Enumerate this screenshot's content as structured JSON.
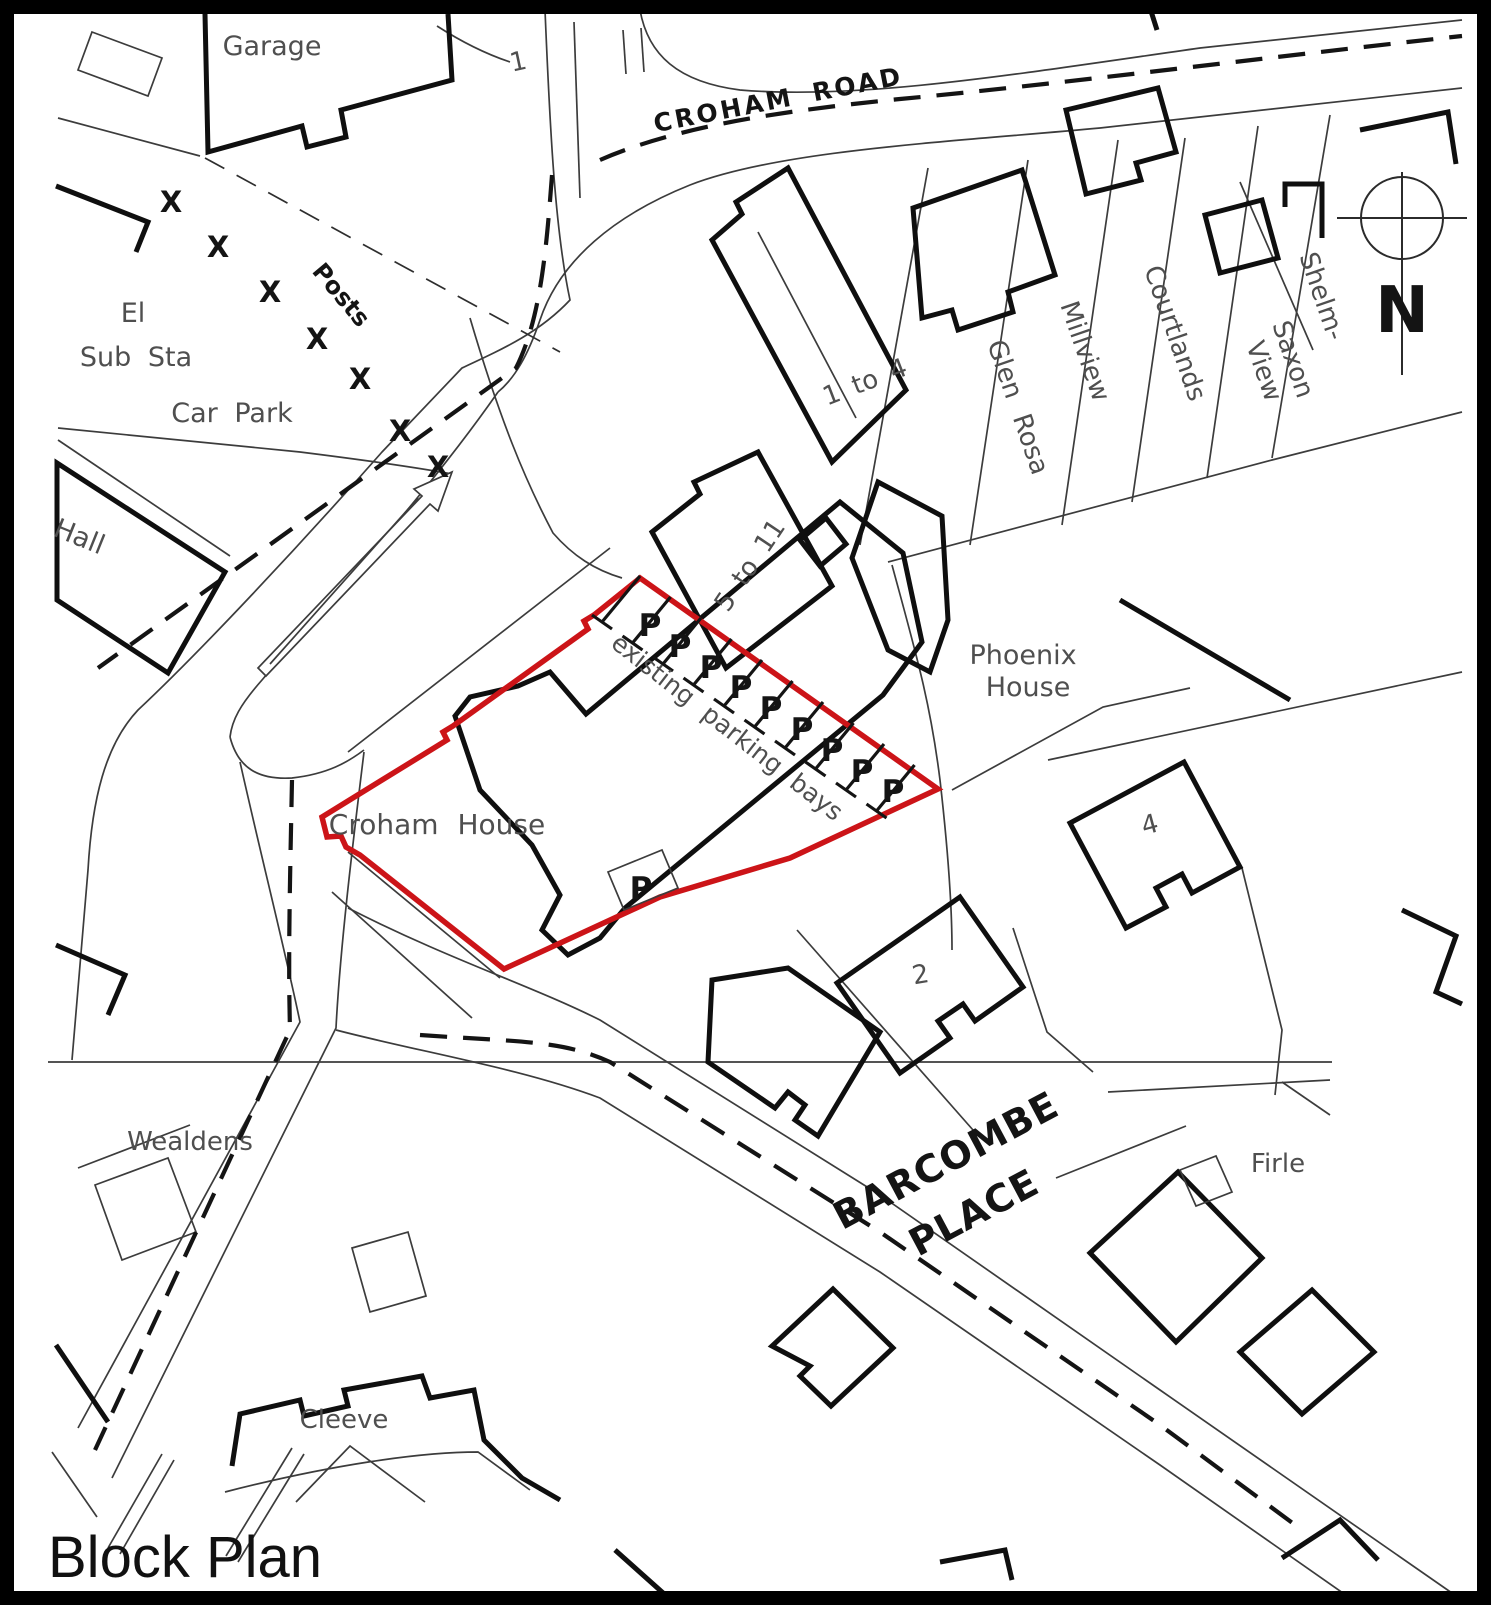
{
  "title": "Block Plan",
  "colors": {
    "site_boundary_red": "#cc1418",
    "building_line": "#0f0f0f",
    "thin_line": "#3c3c3c",
    "label_grey": "#4f4f4f",
    "background": "#ffffff"
  },
  "map": {
    "site": {
      "name": "Croham House",
      "boundary_color": "#cc1418",
      "parking_note": "existing parking bays",
      "parking_bays_in_row": 9,
      "detached_parking_bays": 1
    },
    "roads": [
      "CROHAM ROAD",
      "BARCOMBE PLACE"
    ],
    "places": [
      "Garage",
      "El Sub Sta",
      "Car Park",
      "Posts",
      "Hall",
      "1",
      "1 to 4",
      "5 to 11",
      "Glen Rosa",
      "Millview",
      "Courtlands",
      "Saxon View",
      "Shelm-",
      "Phoenix House",
      "2",
      "4",
      "Wealdens",
      "Firle",
      "Cleeve"
    ]
  },
  "north_arrow": {
    "letter": "N",
    "cx": 1402,
    "cy": 218,
    "r": 41
  },
  "posts": {
    "symbol": "X",
    "positions": [
      {
        "x": 171,
        "y": 212
      },
      {
        "x": 218,
        "y": 257
      },
      {
        "x": 270,
        "y": 302
      },
      {
        "x": 317,
        "y": 349
      },
      {
        "x": 360,
        "y": 389
      },
      {
        "x": 400,
        "y": 441
      },
      {
        "x": 438,
        "y": 477
      }
    ]
  },
  "parking": {
    "symbol": "P",
    "row": [
      {
        "x": 650,
        "y": 636
      },
      {
        "x": 680,
        "y": 657
      },
      {
        "x": 711,
        "y": 678
      },
      {
        "x": 741,
        "y": 698
      },
      {
        "x": 771,
        "y": 719
      },
      {
        "x": 802,
        "y": 740
      },
      {
        "x": 832,
        "y": 761
      },
      {
        "x": 862,
        "y": 782
      },
      {
        "x": 893,
        "y": 802
      }
    ],
    "detached": {
      "x": 641,
      "y": 899
    },
    "dividers": {
      "count": 10,
      "x0": 602,
      "y0": 622,
      "dx": 30.5,
      "dy": 21,
      "vx": 38,
      "vy": -46,
      "capx": 10,
      "capy": 7
    }
  },
  "labels": [
    {
      "name": "label-garage",
      "text": "Garage",
      "x": 272,
      "y": 55,
      "rot": 0,
      "size": 27,
      "cls": "grey"
    },
    {
      "name": "label-plot-1",
      "text": "1",
      "x": 520,
      "y": 70,
      "rot": -12,
      "size": 26,
      "cls": "grey"
    },
    {
      "name": "label-croham-road",
      "text": "CROHAM ROAD",
      "x": 780,
      "y": 108,
      "rot": -11,
      "size": 25,
      "cls": "bold",
      "ls": 3,
      "ws": 8
    },
    {
      "name": "label-el",
      "text": "El",
      "x": 133,
      "y": 322,
      "rot": 0,
      "size": 27,
      "cls": "grey"
    },
    {
      "name": "label-sub-sta",
      "text": "Sub Sta",
      "x": 136,
      "y": 366,
      "rot": 0,
      "size": 27,
      "cls": "grey",
      "ws": 8
    },
    {
      "name": "label-car-park",
      "text": "Car Park",
      "x": 232,
      "y": 422,
      "rot": 0,
      "size": 27,
      "cls": "grey",
      "ws": 8
    },
    {
      "name": "label-posts",
      "text": "Posts",
      "x": 335,
      "y": 300,
      "rot": 50,
      "size": 24,
      "cls": "bold"
    },
    {
      "name": "label-hall",
      "text": "Hall",
      "x": 76,
      "y": 545,
      "rot": 22,
      "size": 27,
      "cls": "grey"
    },
    {
      "name": "label-1-to-4",
      "text": "1 to 4",
      "x": 868,
      "y": 390,
      "rot": -21,
      "size": 26,
      "cls": "grey",
      "ws": 6
    },
    {
      "name": "label-5-to-11",
      "text": "5 to 11",
      "x": 757,
      "y": 570,
      "rot": -56,
      "size": 26,
      "cls": "grey",
      "ws": 6
    },
    {
      "name": "label-glen-rosa",
      "text": "Glen Rosa",
      "x": 1010,
      "y": 410,
      "rot": 71,
      "size": 26,
      "cls": "grey",
      "ws": 10
    },
    {
      "name": "label-millview",
      "text": "Millview",
      "x": 1077,
      "y": 354,
      "rot": 71,
      "size": 26,
      "cls": "grey"
    },
    {
      "name": "label-courtlands",
      "text": "Courtlands",
      "x": 1167,
      "y": 336,
      "rot": 71,
      "size": 26,
      "cls": "grey"
    },
    {
      "name": "label-saxon",
      "text": "Saxon",
      "x": 1285,
      "y": 362,
      "rot": 71,
      "size": 26,
      "cls": "grey"
    },
    {
      "name": "label-view",
      "text": "View",
      "x": 1256,
      "y": 374,
      "rot": 71,
      "size": 26,
      "cls": "grey"
    },
    {
      "name": "label-shelm",
      "text": "Shelm-",
      "x": 1314,
      "y": 299,
      "rot": 71,
      "size": 26,
      "cls": "grey"
    },
    {
      "name": "label-phoenix",
      "text": "Phoenix",
      "x": 1023,
      "y": 664,
      "rot": 0,
      "size": 27,
      "cls": "grey"
    },
    {
      "name": "label-pho-house",
      "text": "House",
      "x": 1028,
      "y": 696,
      "rot": 0,
      "size": 27,
      "cls": "grey"
    },
    {
      "name": "label-existing-parking",
      "text": "existing parking bays",
      "x": 722,
      "y": 734,
      "rot": 38,
      "size": 25,
      "cls": "grey",
      "ws": 9
    },
    {
      "name": "label-croham-house",
      "text": "Croham House",
      "x": 437,
      "y": 834,
      "rot": 0,
      "size": 28,
      "cls": "grey",
      "ws": 10
    },
    {
      "name": "label-no-4",
      "text": "4",
      "x": 1152,
      "y": 833,
      "rot": -15,
      "size": 26,
      "cls": "grey"
    },
    {
      "name": "label-no-2",
      "text": "2",
      "x": 922,
      "y": 983,
      "rot": -10,
      "size": 26,
      "cls": "grey"
    },
    {
      "name": "label-barcombe",
      "text": "BARCOMBE",
      "x": 952,
      "y": 1172,
      "rot": -28,
      "size": 38,
      "cls": "bold",
      "ls": 1
    },
    {
      "name": "label-place",
      "text": "PLACE",
      "x": 980,
      "y": 1224,
      "rot": -28,
      "size": 38,
      "cls": "bold",
      "ls": 1
    },
    {
      "name": "label-wealdens",
      "text": "Wealdens",
      "x": 190,
      "y": 1150,
      "rot": 0,
      "size": 26,
      "cls": "grey"
    },
    {
      "name": "label-firle",
      "text": "Firle",
      "x": 1278,
      "y": 1172,
      "rot": 0,
      "size": 26,
      "cls": "grey"
    },
    {
      "name": "label-cleeve",
      "text": "Cleeve",
      "x": 344,
      "y": 1428,
      "rot": 0,
      "size": 26,
      "cls": "grey"
    },
    {
      "name": "label-north-n",
      "text": "N",
      "x": 1402,
      "y": 332,
      "rot": 0,
      "size": 64,
      "cls": "bold"
    },
    {
      "name": "label-title",
      "text": "Block Plan",
      "x": 48,
      "y": 1577,
      "rot": 0,
      "size": 58,
      "cls": "title",
      "anchor": "start"
    }
  ]
}
